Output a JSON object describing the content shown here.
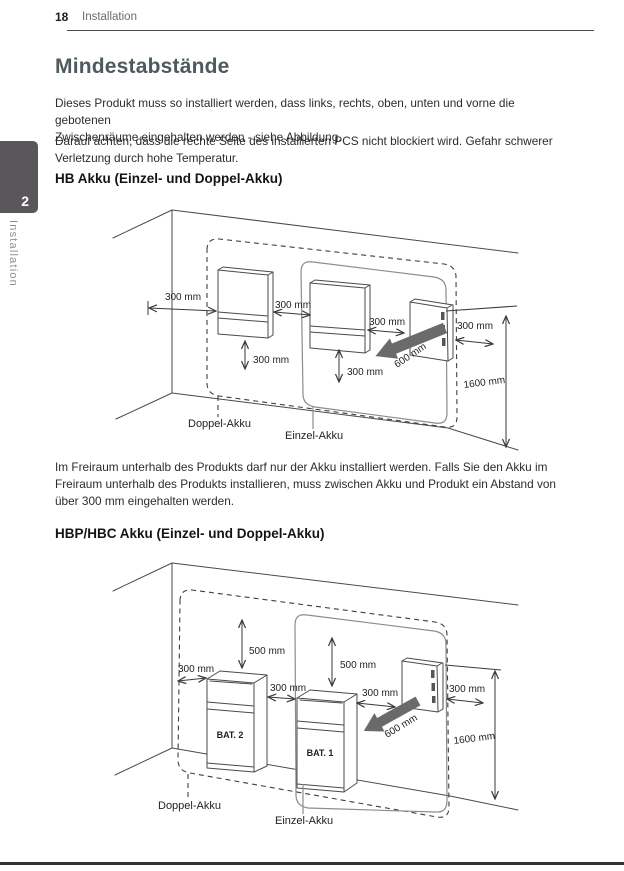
{
  "header": {
    "page_number": "18",
    "section": "Installation"
  },
  "sidebar": {
    "chapter_number": "2",
    "chapter_label": "Installation"
  },
  "title": "Mindestabstände",
  "intro": {
    "p1": [
      "Dieses Produkt muss so installiert werden, dass links, rechts, oben, unten und vorne die gebotenen",
      "Zwischenräume eingehalten werden - siehe Abbildung."
    ],
    "p2": [
      "Darauf achten, dass die rechte Seite des installierten PCS nicht blockiert wird. Gefahr schwerer",
      "Verletzung durch hohe Temperatur."
    ]
  },
  "section_hb": {
    "heading": "HB Akku (Einzel- und Doppel-Akku)"
  },
  "diagram_hb": {
    "dim_left": "300 mm",
    "dim_gap1": "300 mm",
    "dim_gap2": "300 mm",
    "dim_right": "300 mm",
    "dim_below1": "300 mm",
    "dim_below2": "300 mm",
    "dim_depth": "600 mm",
    "dim_height": "1600 mm",
    "label_doppel": "Doppel-Akku",
    "label_einzel": "Einzel-Akku"
  },
  "note": [
    "Im Freiraum unterhalb des Produkts darf nur der Akku installiert werden. Falls Sie den Akku im",
    "Freiraum unterhalb des Produkts installieren, muss zwischen Akku und Produkt ein Abstand von",
    "über 300 mm eingehalten werden."
  ],
  "section_hbp": {
    "heading": "HBP/HBC Akku (Einzel- und Doppel-Akku)"
  },
  "diagram_hbp": {
    "dim_top1": "500 mm",
    "dim_top2": "500 mm",
    "dim_left": "300 mm",
    "dim_gap1": "300 mm",
    "dim_gap2": "300 mm",
    "dim_right": "300 mm",
    "dim_depth": "600 mm",
    "dim_height": "1600 mm",
    "label_bat1": "BAT. 1",
    "label_bat2": "BAT. 2",
    "label_doppel": "Doppel-Akku",
    "label_einzel": "Einzel-Akku"
  },
  "colors": {
    "title_accent": "#4e5a5e",
    "tab_bg": "#59575a",
    "diagram_arrow": "#6a6a6a"
  }
}
